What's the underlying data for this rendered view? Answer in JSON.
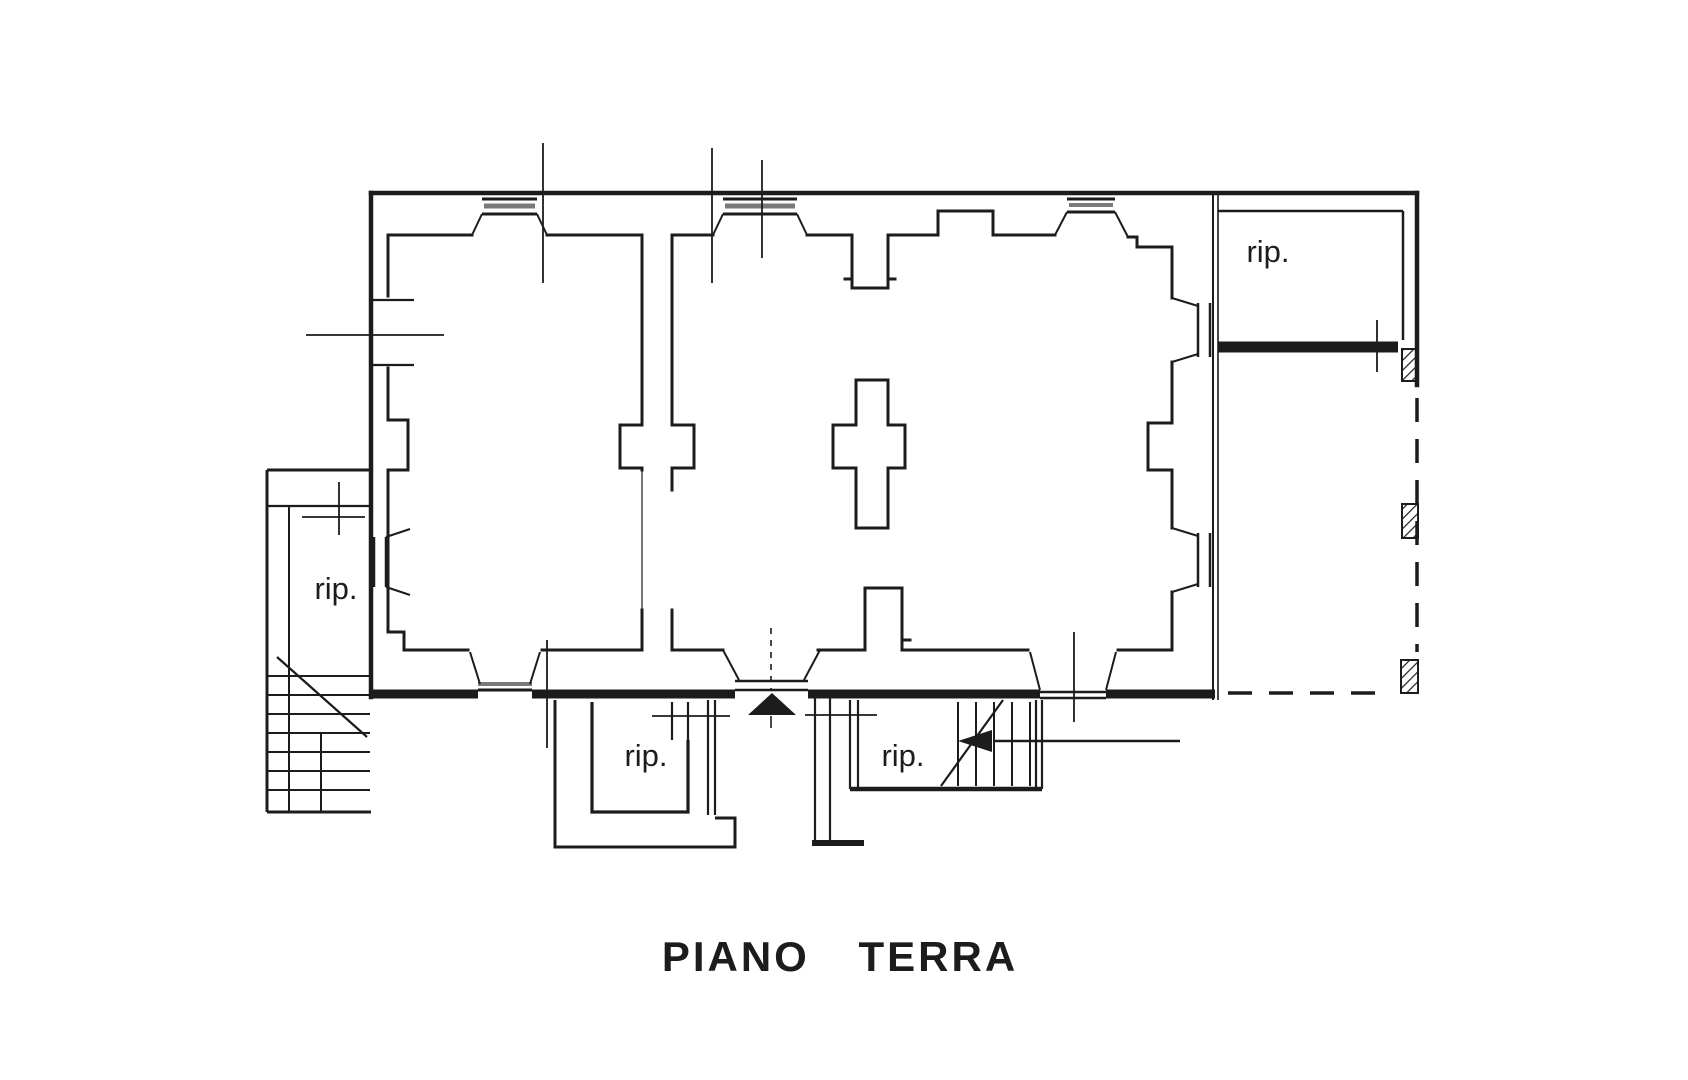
{
  "title": {
    "text": "PIANO TERRA"
  },
  "rooms": [
    {
      "id": "storage-top-right",
      "label": "rip."
    },
    {
      "id": "storage-left-annex",
      "label": "rip."
    },
    {
      "id": "storage-bottom-left",
      "label": "rip."
    },
    {
      "id": "storage-bottom-right",
      "label": "rip."
    }
  ],
  "symbols": {
    "entrance_marker": "filled-triangle-up",
    "stair_direction_marker": "filled-triangle-left",
    "column_fill": "diagonal-hatch"
  },
  "colors": {
    "ink": "#1c1c1c",
    "window_sill_gray": "#7a7a7a",
    "background": "#ffffff"
  }
}
